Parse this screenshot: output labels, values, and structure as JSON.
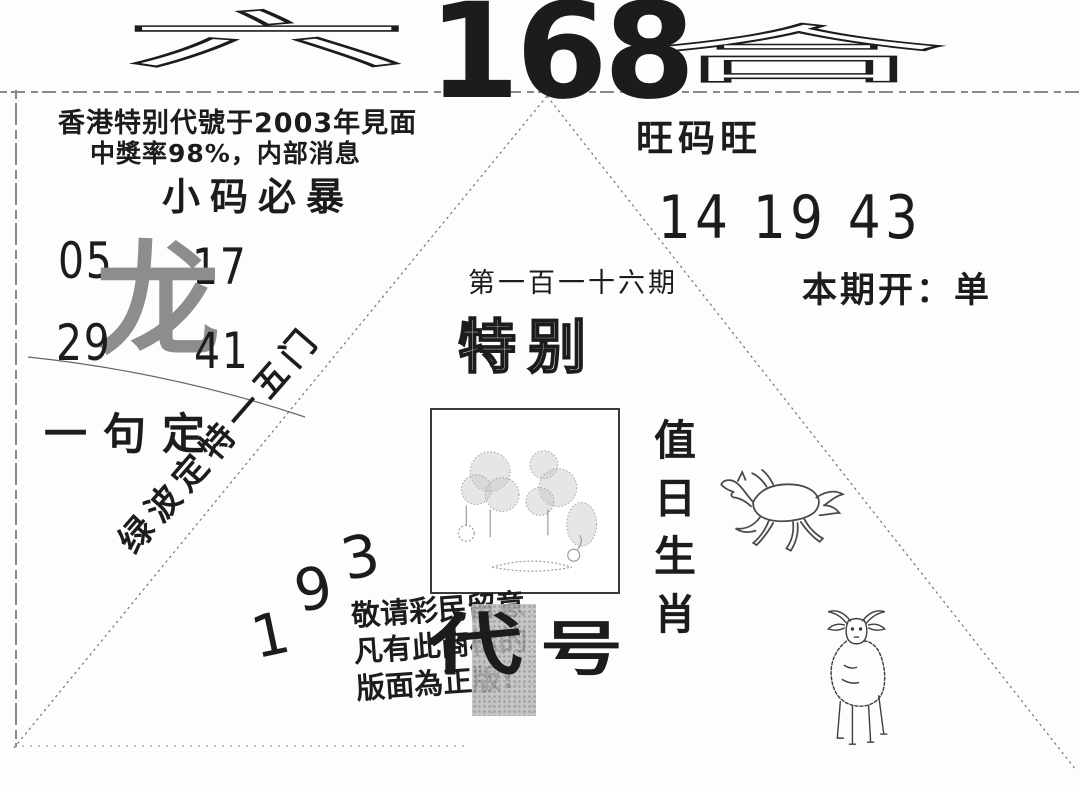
{
  "masthead": {
    "stylized_left": "六",
    "number": "168",
    "stylized_right": "合"
  },
  "top_left": {
    "line1": "香港特别代號于2003年見面",
    "line2": "中獎率98%，内部消息",
    "slogan": "小码必暴"
  },
  "dragon_block": {
    "numbers": [
      "05",
      "17",
      "29",
      "41"
    ],
    "zodiac_char": "龙",
    "phrase": "一句定",
    "diagonal_text": "绿波定特一五门"
  },
  "right_block": {
    "slogan": "旺码旺",
    "lucky_numbers": "14 19 43",
    "draw_result": "本期开：单"
  },
  "center_block": {
    "issue_label": "第一百一十六期",
    "special_title": "特别",
    "duty_chars": [
      "值",
      "日",
      "生",
      "肖"
    ],
    "corner_digits": [
      "1",
      "9",
      "3"
    ],
    "notice_lines": [
      "敬请彩民留意",
      "凡有此商标的",
      "版面為正版!"
    ],
    "code_chars": [
      "代",
      "号"
    ]
  },
  "drawings": {
    "horse": "horse-drawing",
    "goat": "goat-drawing",
    "landscape": "landscape-sketch"
  },
  "colors": {
    "ink": "#1c1c1c",
    "gray_char": "#8d8d8d",
    "patch_gray": "#bdbdbd",
    "line_gray": "#777777",
    "paper": "#fdfdfb"
  }
}
